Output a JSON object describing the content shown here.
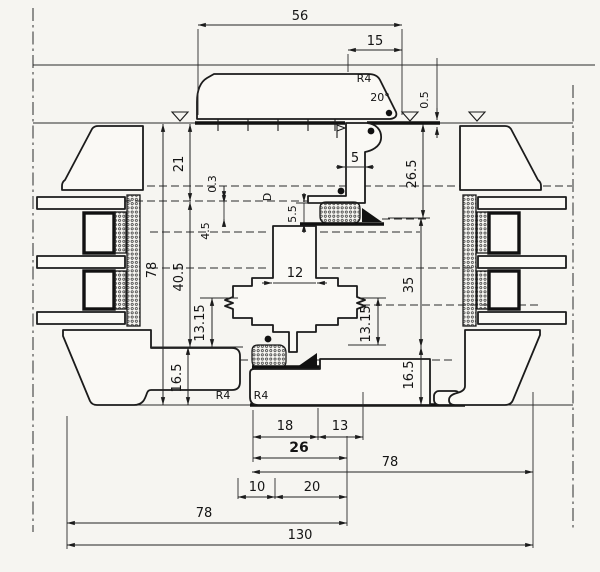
{
  "colors": {
    "ink": "#1b1b1b",
    "paper": "#f6f5f1"
  },
  "labels": {
    "top_width": "56",
    "top_inset": "15",
    "bead_radius": "R4",
    "bead_angle": "20°",
    "face_gap": "0.5",
    "v21": "21",
    "v03": "0.3",
    "v45": "4.5",
    "v405": "40.5",
    "v78": "78",
    "v1315l": "13.15",
    "v165l": "16.5",
    "c5": "5",
    "c55": "5.5",
    "cD": "D",
    "c12": "12",
    "v265": "26.5",
    "v35": "35",
    "v1315r": "13.15",
    "v165r": "16.5",
    "b18": "18",
    "b13": "13",
    "b26": "26",
    "b78r": "78",
    "b10": "10",
    "b20": "20",
    "b78l": "78",
    "b130": "130",
    "r4_left": "R4",
    "r4_mid": "R4"
  }
}
